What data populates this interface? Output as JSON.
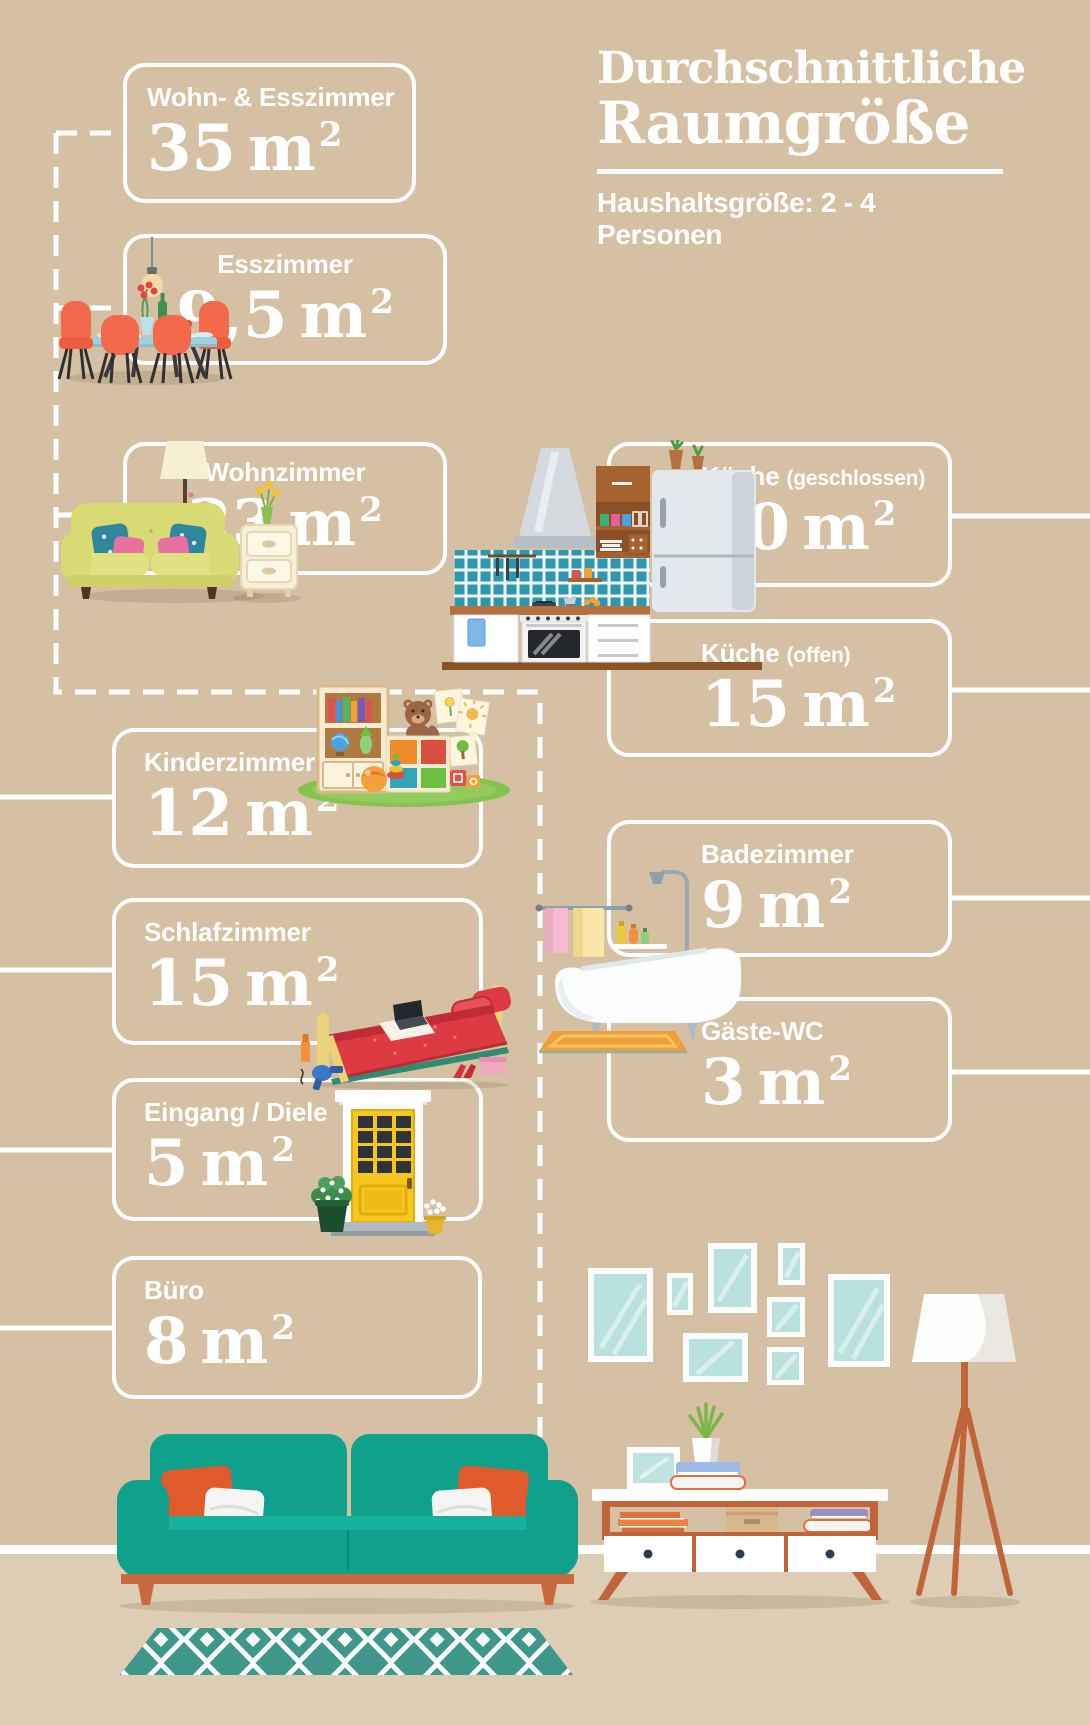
{
  "header": {
    "title_line1": "Durchschnittliche",
    "title_line2": "Raumgröße",
    "subtitle": "Haushaltsgröße: 2 - 4 Personen"
  },
  "unit": {
    "symbol": "m",
    "sup": "2"
  },
  "rooms": {
    "wohn_esszimmer": {
      "label": "Wohn- & Esszimmer",
      "value": "35"
    },
    "esszimmer": {
      "label": "Esszimmer",
      "value": "9,5"
    },
    "wohnzimmer": {
      "label": "Wohnzimmer",
      "value": "23"
    },
    "kueche_geschlossen": {
      "label": "Küche",
      "note": "(geschlossen)",
      "value": "10"
    },
    "kueche_offen": {
      "label": "Küche",
      "note": "(offen)",
      "value": "15"
    },
    "kinderzimmer": {
      "label": "Kinderzimmer",
      "value": "12"
    },
    "badezimmer": {
      "label": "Badezimmer",
      "value": "9"
    },
    "schlafzimmer": {
      "label": "Schlafzimmer",
      "value": "15"
    },
    "gaeste_wc": {
      "label": "Gäste-WC",
      "value": "3"
    },
    "eingang": {
      "label": "Eingang / Diele",
      "value": "5"
    },
    "buero": {
      "label": "Büro",
      "value": "8"
    }
  },
  "chart_data": {
    "type": "table",
    "title": "Durchschnittliche Raumgröße",
    "subtitle": "Haushaltsgröße: 2 - 4 Personen",
    "categories": [
      "Wohn- & Esszimmer",
      "Esszimmer",
      "Wohnzimmer",
      "Küche (geschlossen)",
      "Küche (offen)",
      "Kinderzimmer",
      "Badezimmer",
      "Schlafzimmer",
      "Gäste-WC",
      "Eingang / Diele",
      "Büro"
    ],
    "values": [
      35,
      9.5,
      23,
      10,
      15,
      12,
      9,
      15,
      3,
      5,
      8
    ],
    "unit": "m²"
  },
  "colors": {
    "wall": "#d5c0a3",
    "floor": "#decdb5",
    "line_white": "#ffffff",
    "sofa_teal": "#10a18c",
    "accent_orange": "#e05a2b",
    "wood_orange": "#c0653a",
    "rug_teal": "#3f968b",
    "frame_glass": "#b9e2df"
  }
}
